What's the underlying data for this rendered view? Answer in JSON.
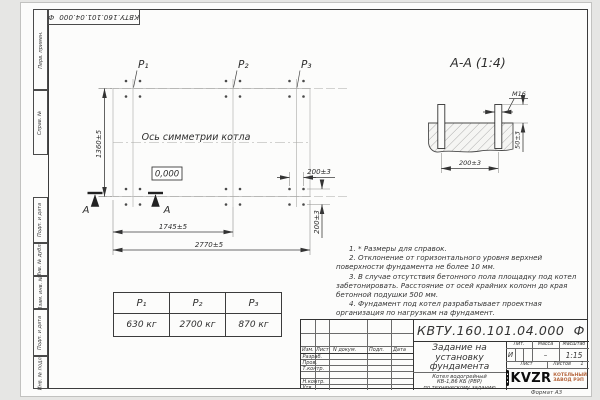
{
  "sheet": {
    "doc_number": "КВТУ.160.101.04.000  Ф",
    "format_label": "Формат А3",
    "frame_labels_top": [
      "Перв. примен.",
      "Справ. №"
    ],
    "frame_labels_bottom": [
      "Подп. и дата",
      "Инв. № дубл.",
      "Взам. инв. №",
      "Подп. и дата",
      "Инв. № подл."
    ]
  },
  "plan": {
    "axis_label": "Ось симметрии котла",
    "level_mark": "0,000",
    "point_labels": [
      "P₁",
      "P₂",
      "P₃"
    ],
    "section_letter": "А",
    "dim_height": "1360±5",
    "dim_width_inner": "1745±5",
    "dim_width_outer": "2770±5",
    "dim_bolt_h": "200±3",
    "dim_bolt_v": "200±3"
  },
  "section": {
    "title": "А-А (1:4)",
    "thread_label": "М16",
    "dim_protrusion": "50±3",
    "dim_spacing": "200±3"
  },
  "notes": {
    "items": [
      "1. * Размеры для справок.",
      "2. Отклонение от горизонтального уровня верхней поверхности фундамента не более 10 мм.",
      "3. В случае отсутствия бетонного пола площадку под котел забетонировать. Расстояние от осей крайних колонн до края бетонной подушки 500 мм.",
      "4. Фундамент под котел разрабатывает проектная организация по нагрузкам на фундамент."
    ]
  },
  "loads_table": {
    "headers": [
      "P₁",
      "P₂",
      "P₃"
    ],
    "values": [
      "630 кг",
      "2700 кг",
      "870 кг"
    ]
  },
  "title_block": {
    "rev_headers": [
      "Изм.",
      "Лист",
      "N докум.",
      "Подп.",
      "Дата"
    ],
    "sign_labels": [
      "Разраб.",
      "Пров.",
      "Т.контр.",
      "Н.контр.",
      "Утв."
    ],
    "title_lines": [
      "Задание на",
      "установку",
      "фундамента"
    ],
    "product_lines": [
      "Котел водогрейный",
      "КВ-1,86 КБ (РВР)",
      "по техническому заданию"
    ],
    "lit_header": "Лит.",
    "lit_value": "И",
    "mass_header": "Масса",
    "mass_value": "–",
    "scale_header": "Масштаб",
    "scale_value": "1:15",
    "sheet_header": "Лист",
    "sheets_header": "Листов",
    "sheets_value": "1",
    "logo_text": "KVZR",
    "company_line1": "КОТЕЛЬНЫЙ",
    "company_line2": "ЗАВОД РЭП"
  },
  "colors": {
    "logo_accent": "#b5643a",
    "line_dark": "#3c3c3c"
  }
}
